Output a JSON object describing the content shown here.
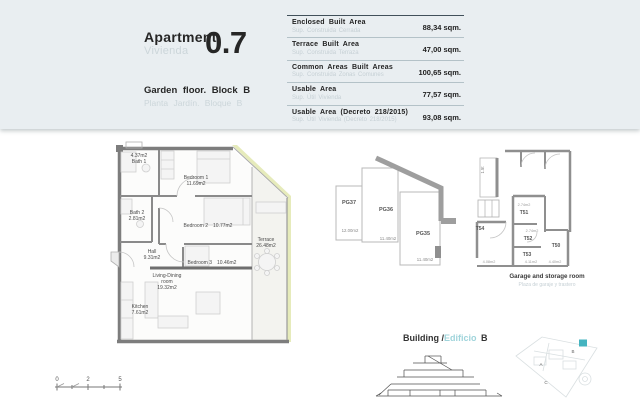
{
  "header": {
    "apartment_label": "Apartment",
    "apartment_label_es": "Vivienda",
    "unit_number": "0.7",
    "floor_label": "Garden floor. Block B",
    "floor_label_es": "Planta Jardín. Bloque B"
  },
  "area_table": {
    "rows": [
      {
        "label": "Enclosed Built Area",
        "label_es": "Sup. Construida Cerrada",
        "value": "88,34 sqm."
      },
      {
        "label": "Terrace Built Area",
        "label_es": "Sup. Construida Terraza",
        "value": "47,00 sqm."
      },
      {
        "label": "Common Areas Built Areas",
        "label_es": "Sup. Construida Zonas Comunes",
        "value": "100,65 sqm."
      },
      {
        "label": "Usable Area",
        "label_es": "Sup. Útil Vivienda",
        "value": "77,57 sqm."
      },
      {
        "label": "Usable Area (Decreto 218/2015)",
        "label_es": "Sup. Útil Vivienda (Decreto 218/2015)",
        "value": "93,08 sqm."
      }
    ]
  },
  "floor_plan": {
    "rooms": {
      "bath1": {
        "area": "4.37m2",
        "name": "Bath 1"
      },
      "bedroom1": {
        "name": "Bedroom 1",
        "area": "11.69m2"
      },
      "bath2": {
        "name": "Bath 2",
        "area": "2.81m2"
      },
      "bedroom2": {
        "name": "Bedroom 2",
        "area": "10.77m2"
      },
      "hall": {
        "name": "Hall",
        "area": "9.31m2"
      },
      "bedroom3": {
        "name": "Bedroom 3",
        "area": "10.46m2"
      },
      "living": {
        "name1": "Living-Dining",
        "name2": "room",
        "area": "19.32m2"
      },
      "kitchen": {
        "name": "Kitchen",
        "area": "7.61m2"
      },
      "terrace": {
        "name": "Terrace",
        "area": "26.48m2"
      }
    }
  },
  "garage": {
    "spaces": [
      {
        "label": "PG37",
        "area": "12.00m2"
      },
      {
        "label": "PG36",
        "area": "11.40m2"
      },
      {
        "label": "PG35",
        "area": "11.40m2"
      }
    ],
    "lift_label": "1.5t"
  },
  "storage": {
    "units": [
      {
        "label": "T51",
        "area": "2.74m2"
      },
      {
        "label": "T52",
        "area": "2.74m2"
      },
      {
        "label": "T53",
        "area": "4.11m2"
      },
      {
        "label": "T50",
        "area": "4.40m2"
      },
      {
        "label": "T54",
        "area": "4.08m2"
      }
    ],
    "caption": "Garage and storage room",
    "caption_es": "Plaza de garaje y trastero"
  },
  "building": {
    "label": "Building /",
    "label_es": "Edificio",
    "block": "B"
  },
  "site": {
    "a": "A",
    "b": "B",
    "c": "C"
  },
  "scale": {
    "t0": "0",
    "t1": "2",
    "t2": "5"
  },
  "colors": {
    "accent_teal": "#45b4c0",
    "band_bg": "#e9eef1",
    "muted_gray": "#c6d0d5",
    "facade_highlight": "#e6ebbb"
  }
}
